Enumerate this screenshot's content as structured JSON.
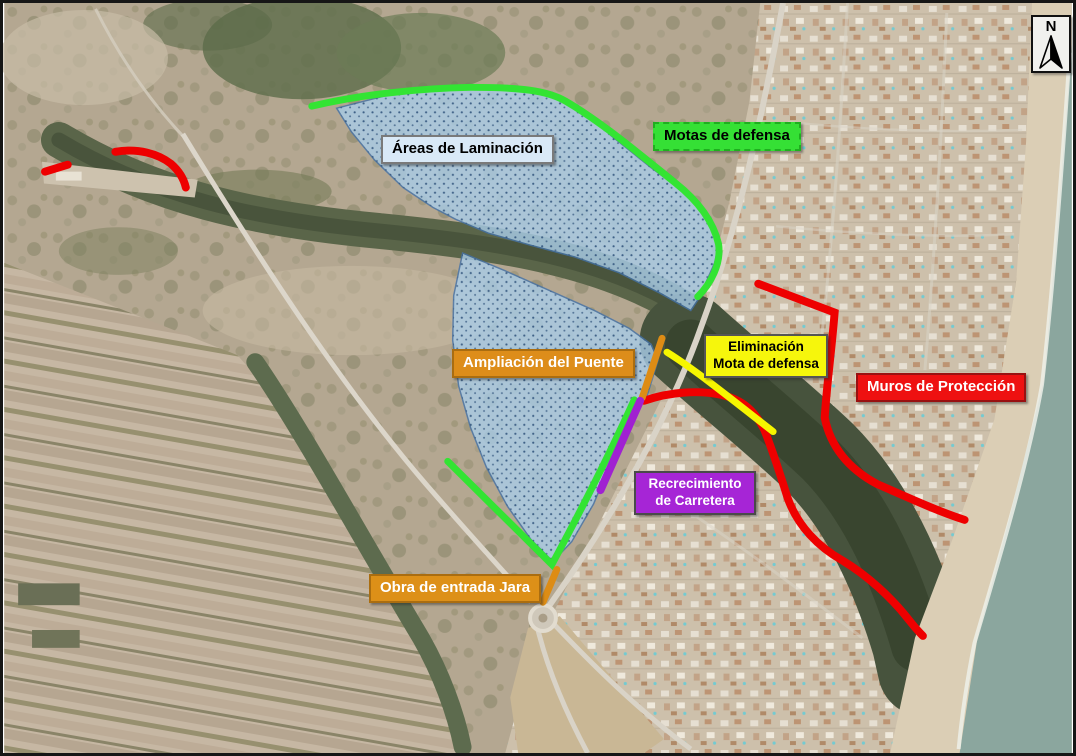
{
  "labels": {
    "areas_laminacion": {
      "text": "Áreas de Laminación",
      "bg": "#d9e9f7",
      "border": "#7a7a7a",
      "fg": "#000000"
    },
    "motas_defensa": {
      "text": "Motas de defensa",
      "bg": "#35e035",
      "border": "#1fae1f",
      "fg": "#000000"
    },
    "ampliacion_puente": {
      "text": "Ampliación del Puente",
      "bg": "#dd8d1a",
      "border": "#aa6d10",
      "fg": "#ffffff"
    },
    "eliminacion_mota": {
      "line1": "Eliminación",
      "line2": "Mota de defensa",
      "bg": "#f6f60c",
      "border": "#555555",
      "fg": "#000000"
    },
    "muros_proteccion": {
      "text": "Muros de Protección",
      "bg": "#ee1111",
      "border": "#991111",
      "fg": "#ffffff"
    },
    "recrecimiento": {
      "line1": "Recrecimiento",
      "line2": "de Carretera",
      "bg": "#a625d6",
      "border": "#4a4a4a",
      "fg": "#ffffff"
    },
    "obra_jara": {
      "text": "Obra de entrada Jara",
      "bg": "#dd9018",
      "border": "#aa6d10",
      "fg": "#ffffff"
    }
  },
  "north_arrow": {
    "letter": "N"
  },
  "features": {
    "flood_area": {
      "fill": "#a9cde9",
      "stroke": "#4472a8",
      "dot": "#33567e"
    },
    "mota_defensa_line": {
      "color": "#33e433"
    },
    "muro_line": {
      "color": "#ee0000"
    },
    "eliminacion_line": {
      "color": "#f6f600"
    },
    "obra_line": {
      "color": "#dd8c15"
    },
    "carretera_line": {
      "color": "#a021d1"
    }
  }
}
